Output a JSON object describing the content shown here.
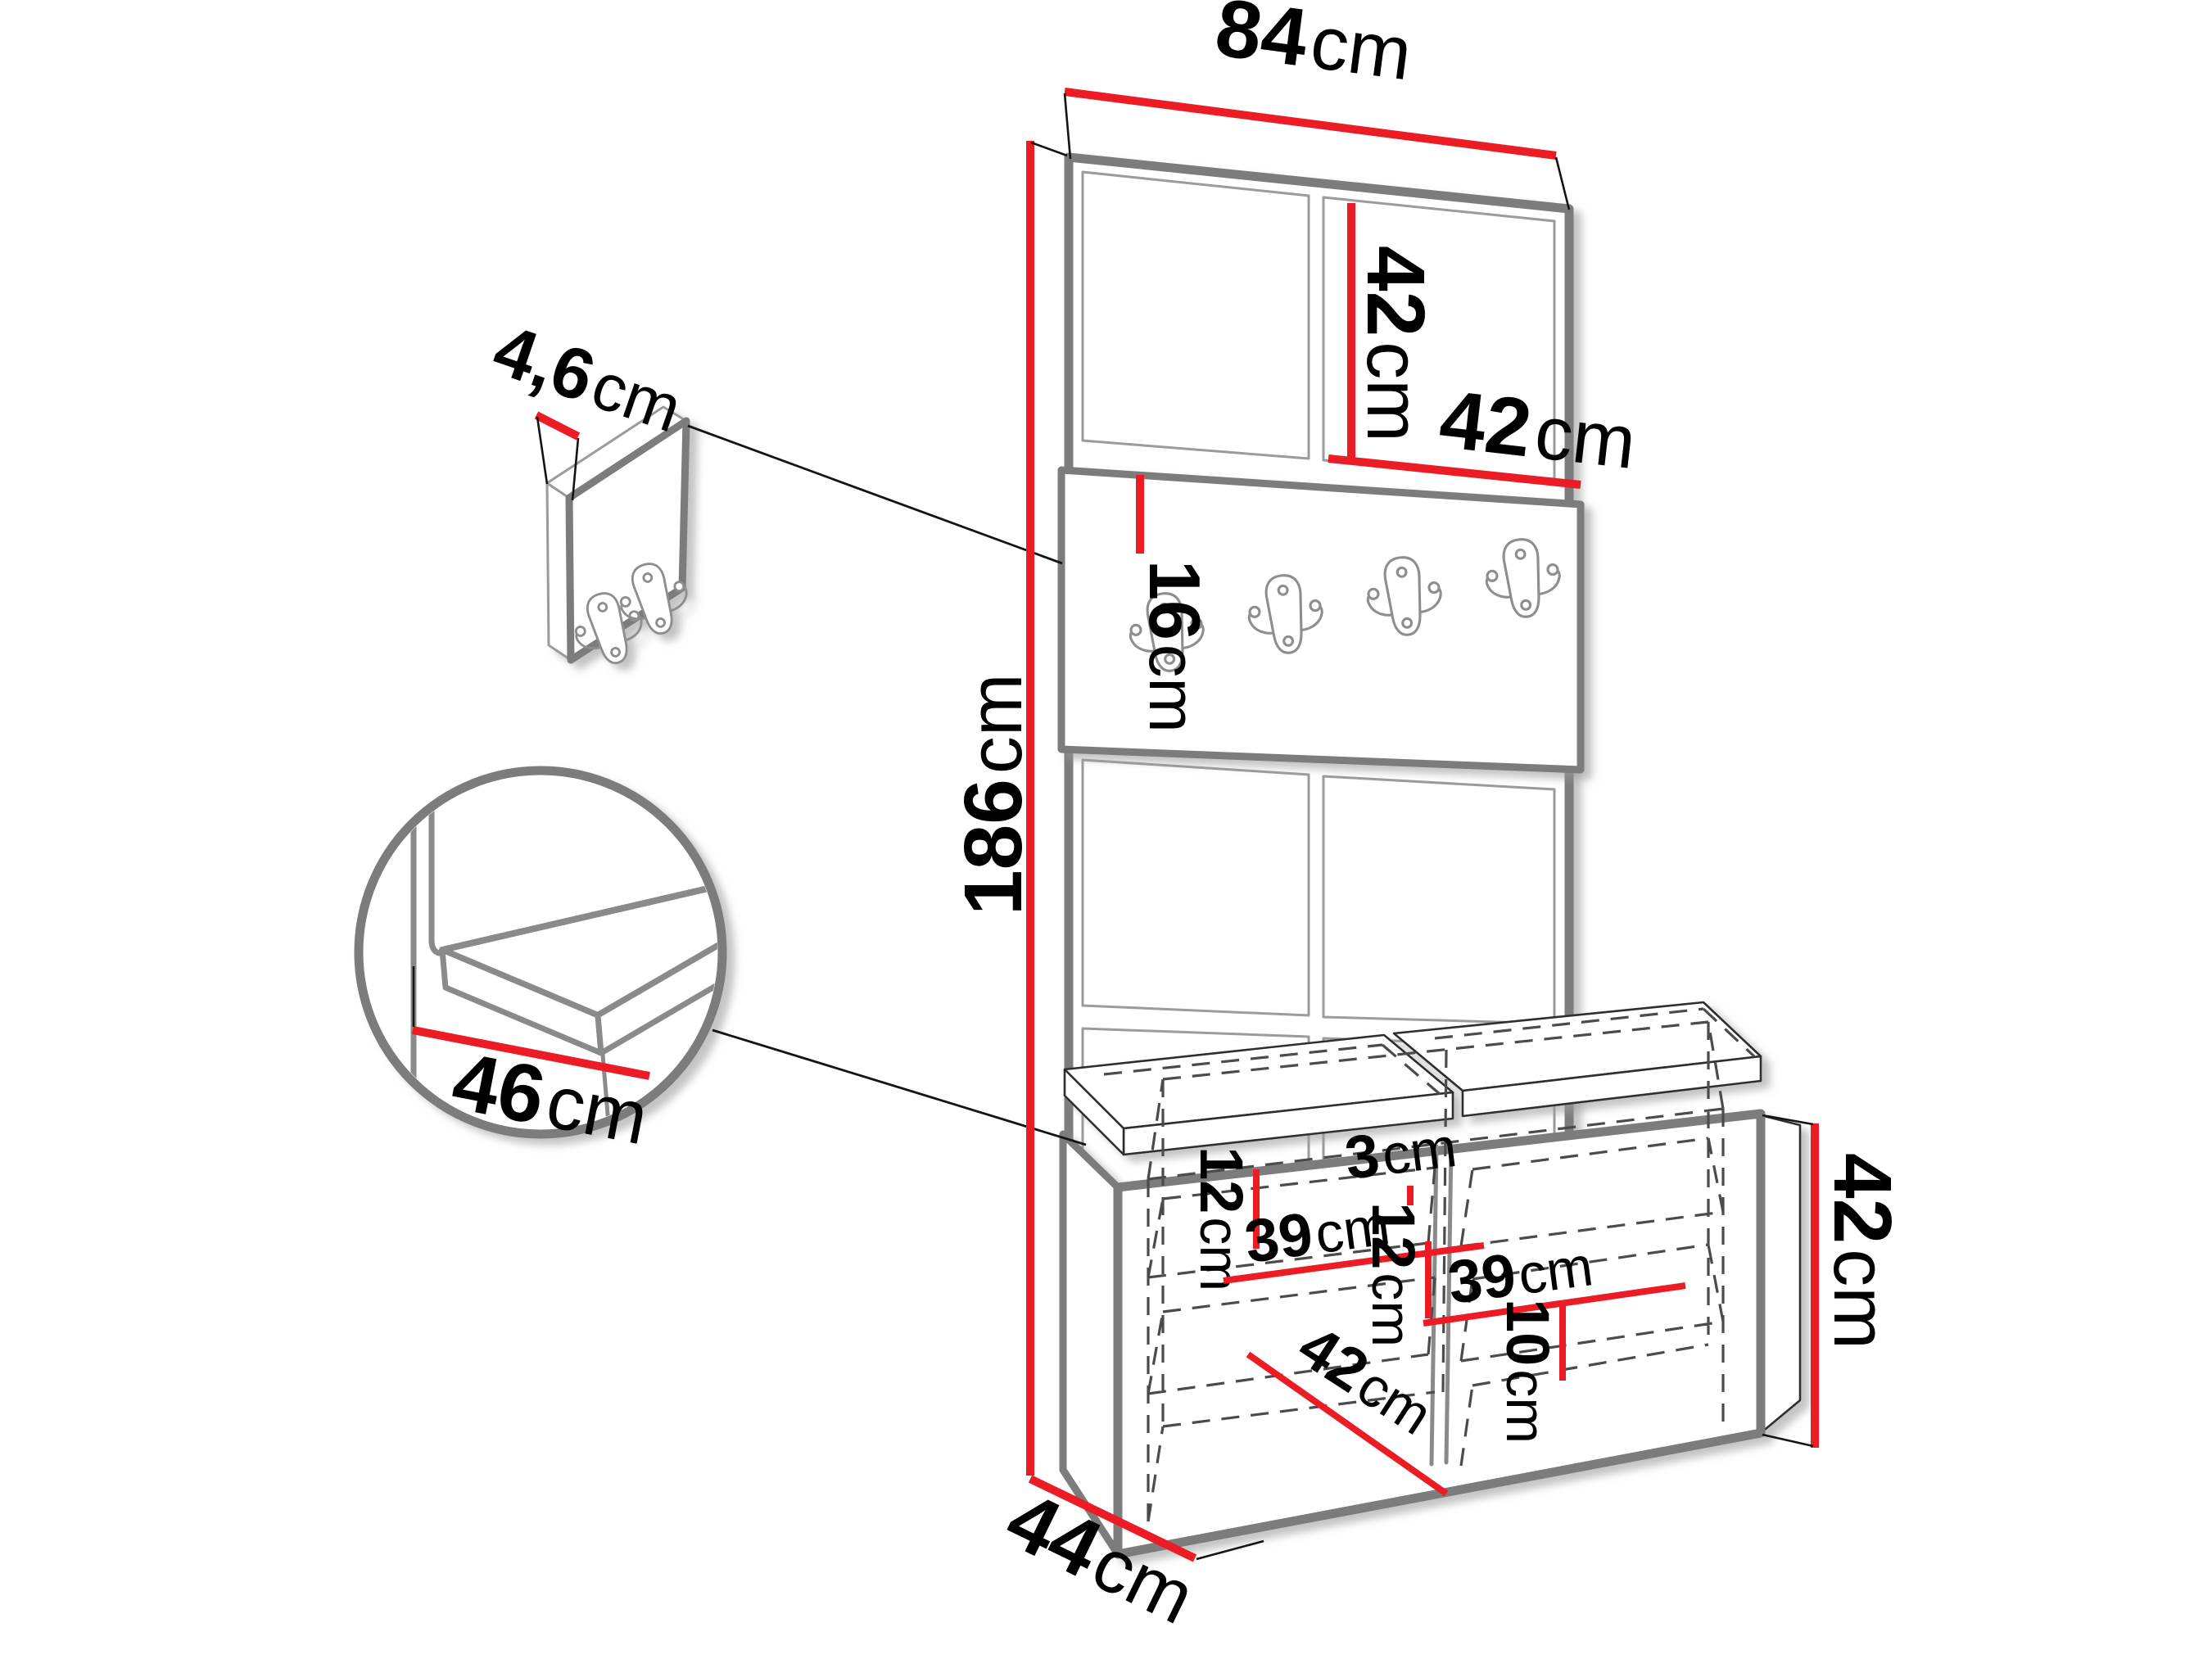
{
  "diagram": {
    "type": "furniture-dimension-drawing",
    "subject": "hallway set: tall upholstered panel with coat-hook rail and shoe bench",
    "background": "#ffffff",
    "colors": {
      "dimension_red": "#ec1c24",
      "outline_grey": "#7b7b7b",
      "thin_line_black": "#141414",
      "hidden_edge_grey": "#4b4b4b"
    }
  },
  "icons": {
    "hook": "double-coat-hook-icon"
  },
  "dimensions": {
    "top_width": {
      "value": "84",
      "unit": "cm"
    },
    "upper_panel_height": {
      "value": "42",
      "unit": "cm"
    },
    "upper_panel_width": {
      "value": "42",
      "unit": "cm"
    },
    "hook_rail_height": {
      "value": "16",
      "unit": "cm"
    },
    "total_height": {
      "value": "186",
      "unit": "cm"
    },
    "wall_panel_thickness": {
      "value": "4,6",
      "unit": "cm"
    },
    "seat_depth": {
      "value": "46",
      "unit": "cm"
    },
    "left_top_section_height": {
      "value": "12",
      "unit": "cm"
    },
    "left_shelf_width": {
      "value": "39",
      "unit": "cm"
    },
    "divider_thickness": {
      "value": "3",
      "unit": "cm"
    },
    "right_top_section_height": {
      "value": "12",
      "unit": "cm"
    },
    "right_shelf_width": {
      "value": "39",
      "unit": "cm"
    },
    "inner_depth": {
      "value": "42",
      "unit": "cm"
    },
    "bottom_section_height": {
      "value": "10",
      "unit": "cm"
    },
    "bench_height": {
      "value": "42",
      "unit": "cm"
    },
    "bench_depth": {
      "value": "44",
      "unit": "cm"
    }
  }
}
